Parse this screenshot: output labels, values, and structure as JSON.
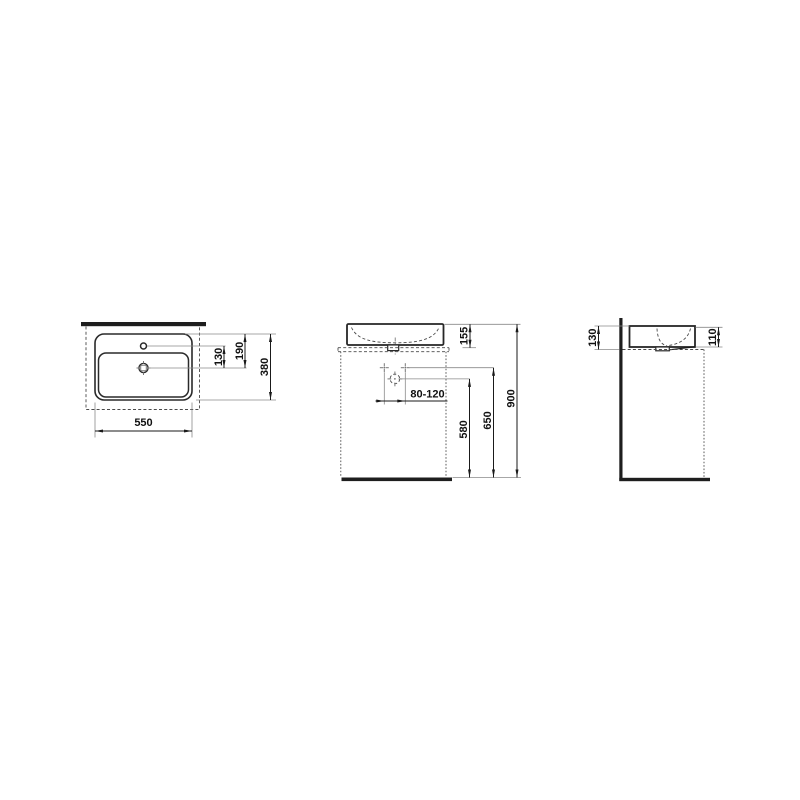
{
  "drawing": {
    "subject": "washbasin technical dimension drawing",
    "colors": {
      "line": "#1a1a1a",
      "background": "#ffffff",
      "reference_gray": "#8a8a8a"
    }
  },
  "views": {
    "plan": {
      "dim_width": "550",
      "dim_depth": "380",
      "dim_tap_to_drain": "130",
      "dim_rim_to_drain": "190"
    },
    "front": {
      "dim_basin_height": "155",
      "dim_drain_offset": "80-120",
      "dim_drain_height": "580",
      "dim_fixing_height": "650",
      "dim_rim_height": "900"
    },
    "side": {
      "dim_back_height": "130",
      "dim_front_height": "110"
    }
  }
}
